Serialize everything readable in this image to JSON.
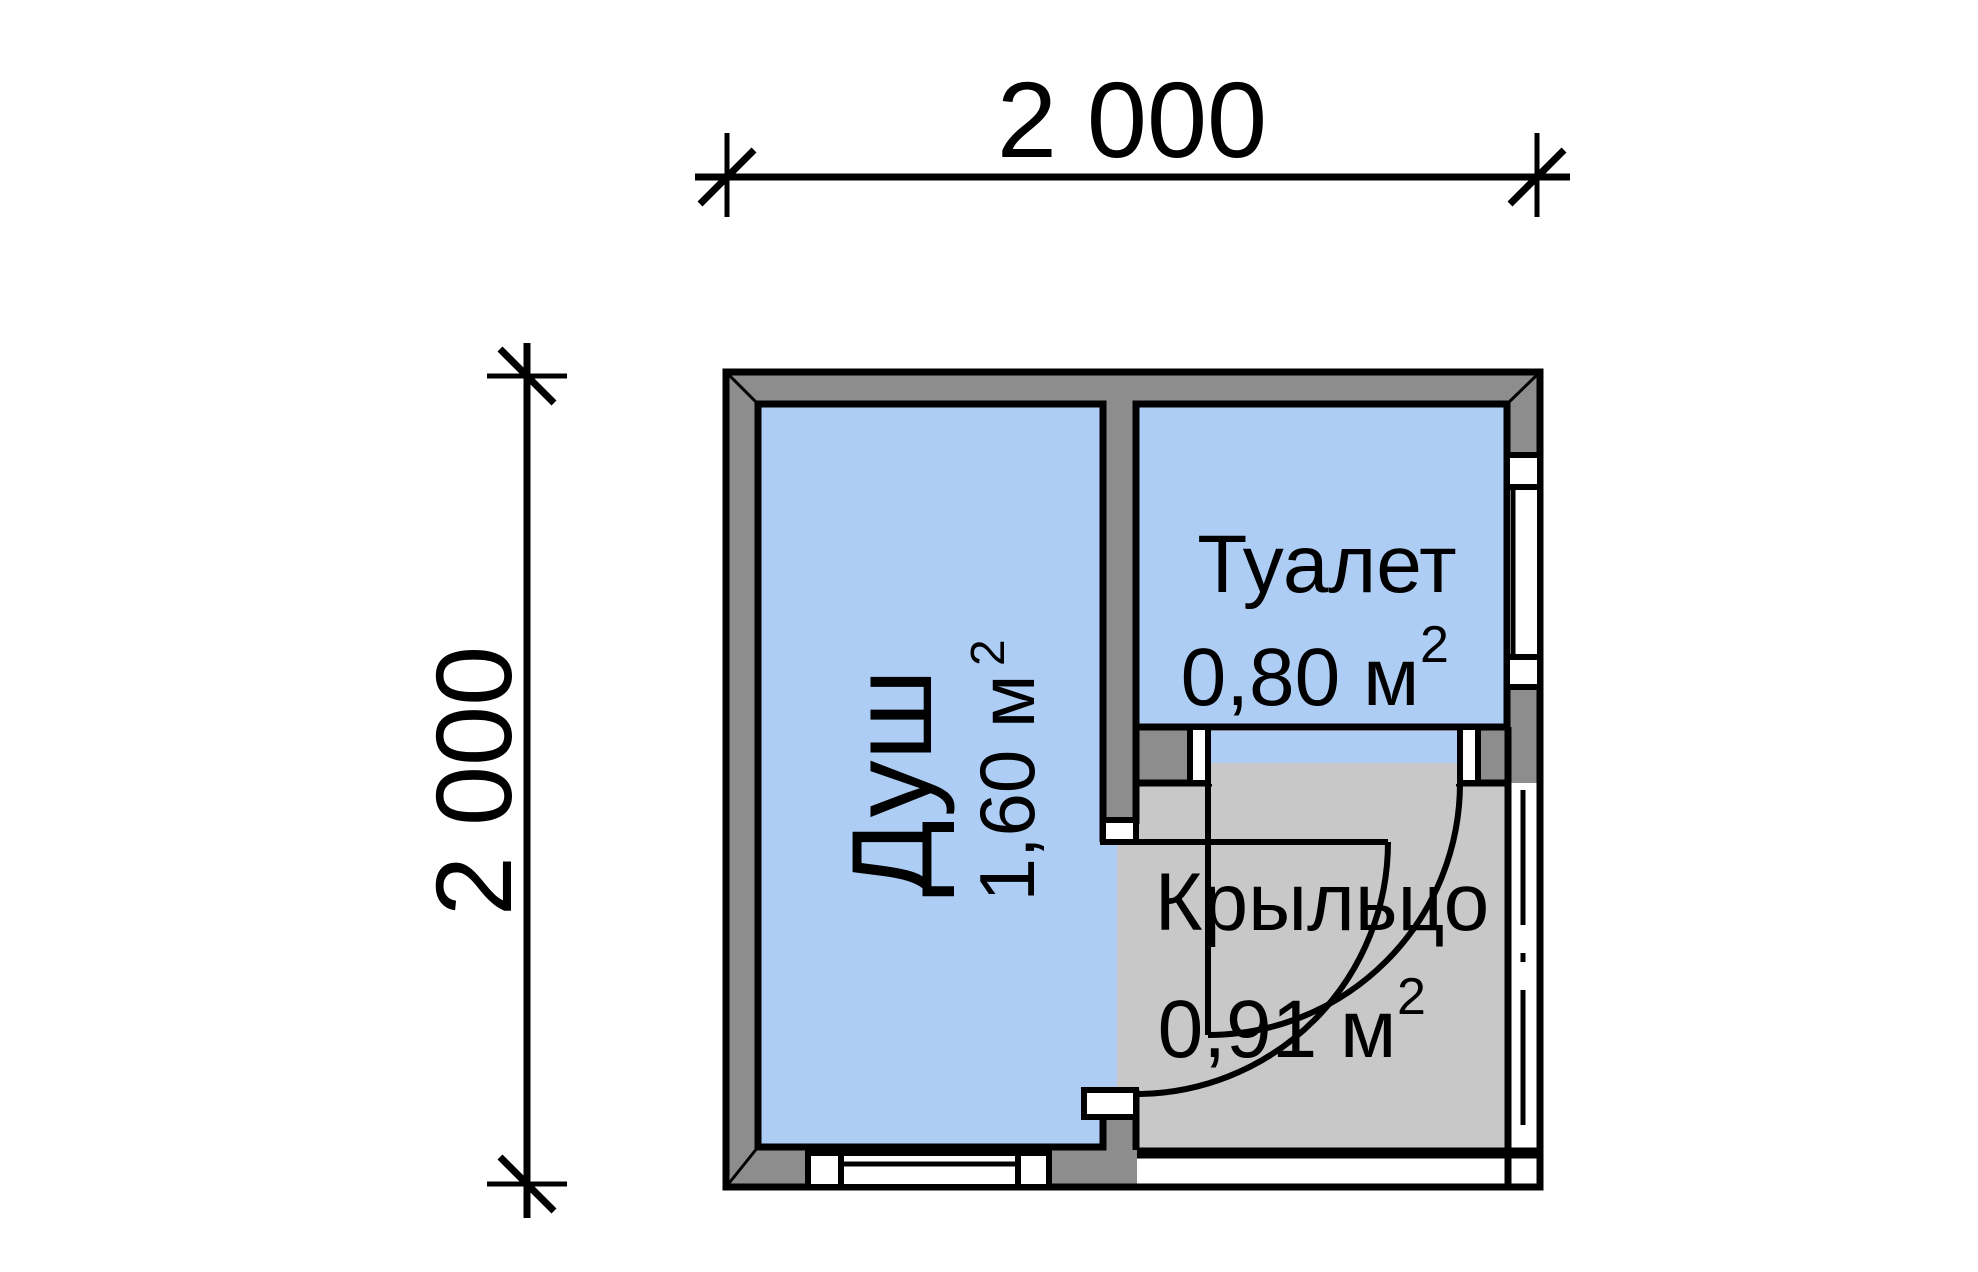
{
  "dimensions": {
    "width_label": "2 000",
    "height_label": "2 000"
  },
  "rooms": {
    "shower": {
      "label": "Душ",
      "area": "1,60 м",
      "area_sup": "2"
    },
    "toilet": {
      "label": "Туалет",
      "area": "0,80 м",
      "area_sup": "2"
    },
    "porch": {
      "label": "Крыльцо",
      "area": "0,91 м",
      "area_sup": "2"
    }
  },
  "colors": {
    "room_fill": "#aecdf5",
    "wall_fill": "#8d8d8d",
    "porch_fill": "#c8c8c8",
    "line": "#000000",
    "background": "#ffffff"
  }
}
